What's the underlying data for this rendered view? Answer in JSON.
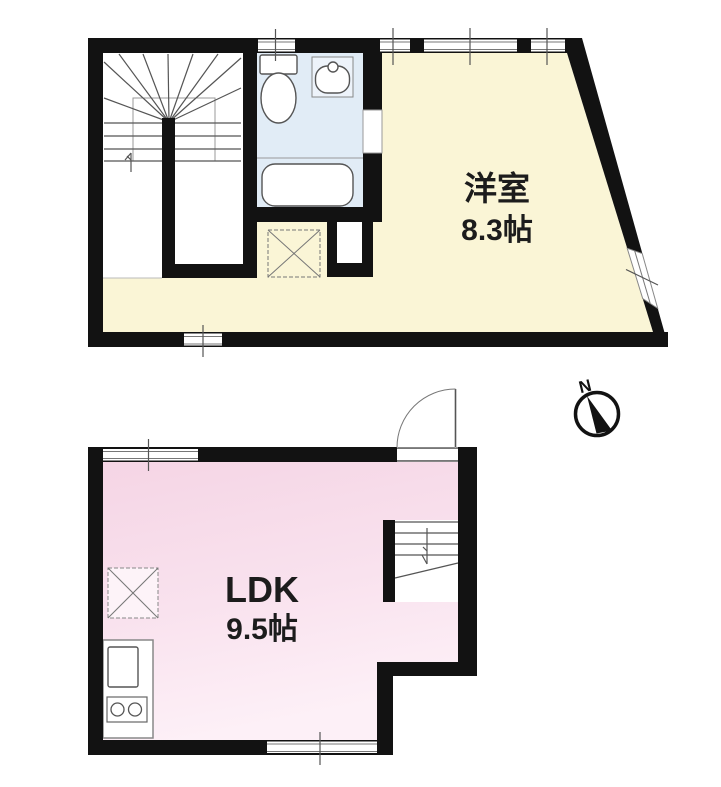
{
  "diagram_type": "floor-plan",
  "compass": {
    "north_label": "N"
  },
  "floor2": {
    "room": {
      "label": "洋室",
      "size": "8.3帖"
    },
    "fixtures": [
      "staircase",
      "toilet",
      "washbasin",
      "bathtub",
      "washer-pan",
      "closet-niche"
    ],
    "floor_color": "#faf5d6",
    "bathroom_color": "#e1ecf6"
  },
  "floor1": {
    "room": {
      "label": "LDK",
      "size": "9.5帖"
    },
    "fixtures": [
      "staircase",
      "kitchen-sink",
      "two-burner-stove",
      "refrigerator-space",
      "entrance-door"
    ],
    "floor_color_top": "#f6d7e7",
    "floor_color_bottom": "#fdf0f7"
  },
  "wall_color": "#121212"
}
